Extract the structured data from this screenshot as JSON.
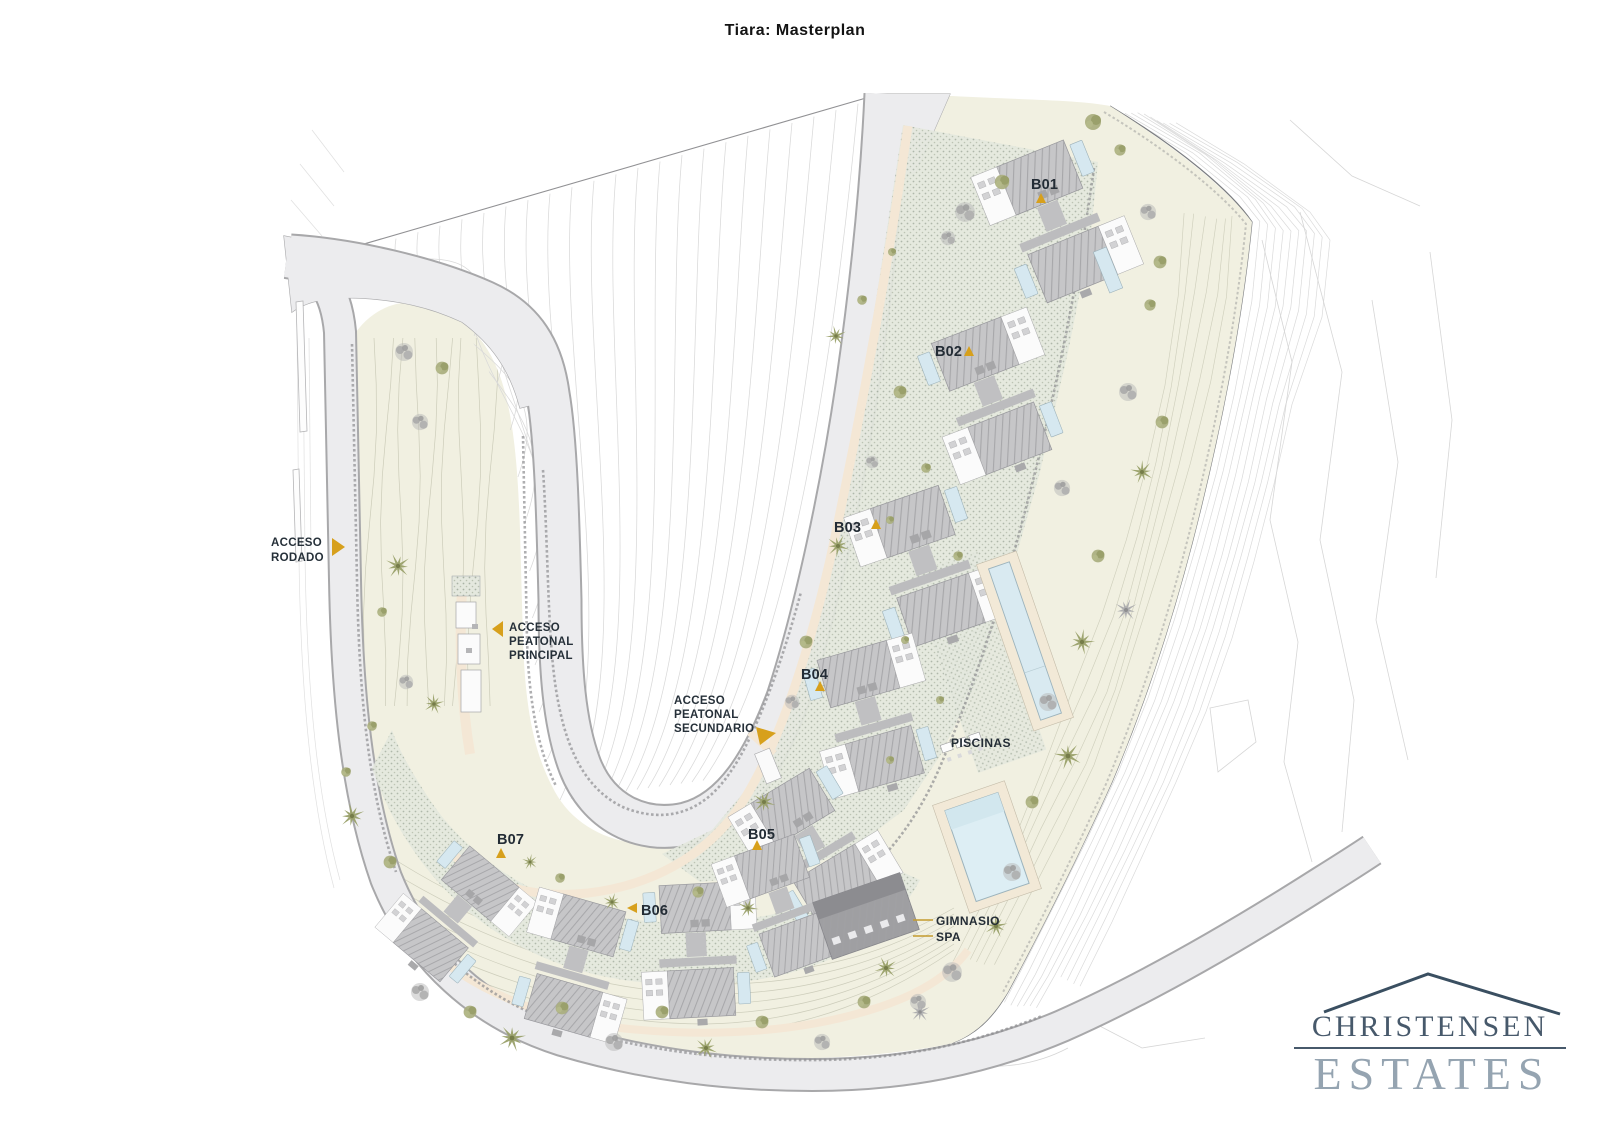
{
  "title": "Tiara: Masterplan",
  "plan": {
    "buildings": {
      "b01": "B01",
      "b02": "B02",
      "b03": "B03",
      "b04": "B04",
      "b05": "B05",
      "b06": "B06",
      "b07": "B07"
    },
    "access": {
      "rodado": [
        "ACCESO",
        "RODADO"
      ],
      "peatonal_principal": [
        "ACCESO",
        "PEATONAL",
        "PRINCIPAL"
      ],
      "peatonal_secundario": [
        "ACCESO",
        "PEATONAL",
        "SECUNDARIO"
      ]
    },
    "facilities": {
      "piscinas": "PISCINAS",
      "gimnasio": "GIMNASIO",
      "spa": "SPA"
    }
  },
  "logo": {
    "line1": "CHRISTENSEN",
    "line2": "ESTATES"
  },
  "colors": {
    "accent_gold": "#d7a01c",
    "label_ink": "#242d37",
    "logo_dark": "#47596b",
    "logo_light": "#95a4b1"
  }
}
